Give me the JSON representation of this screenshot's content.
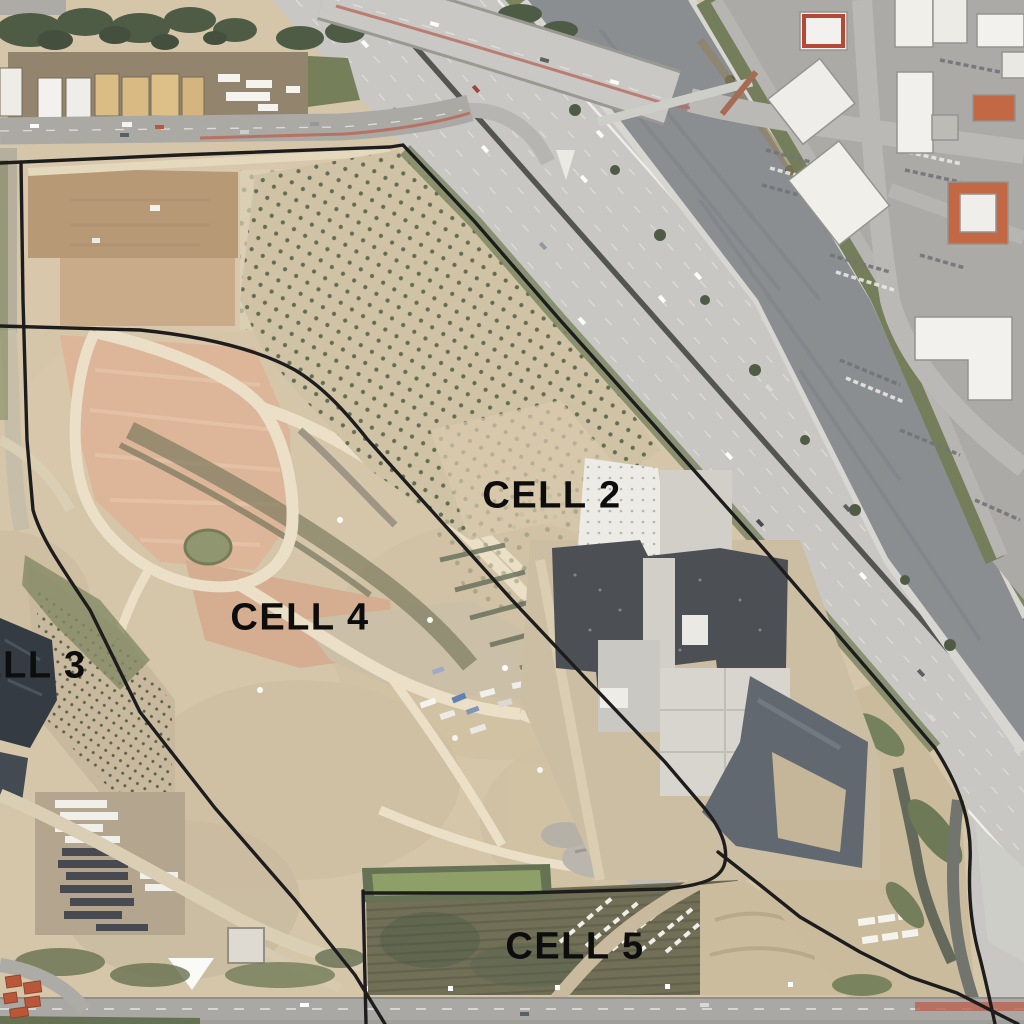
{
  "map": {
    "type": "aerial-site-map",
    "labels": [
      {
        "id": "cell-2",
        "text": "CELL 2"
      },
      {
        "id": "cell-3",
        "text": "CELL 3"
      },
      {
        "id": "cell-4",
        "text": "CELL 4"
      },
      {
        "id": "cell-5",
        "text": "CELL 5"
      }
    ],
    "colors": {
      "boundary_line": "#1d1d1d",
      "label_text": "#0d0d0d",
      "dirt": "#d3c3a6",
      "freeway": "#c6c5c1",
      "channel_water": "#85888c",
      "vegetation": "#6e7a52"
    }
  }
}
